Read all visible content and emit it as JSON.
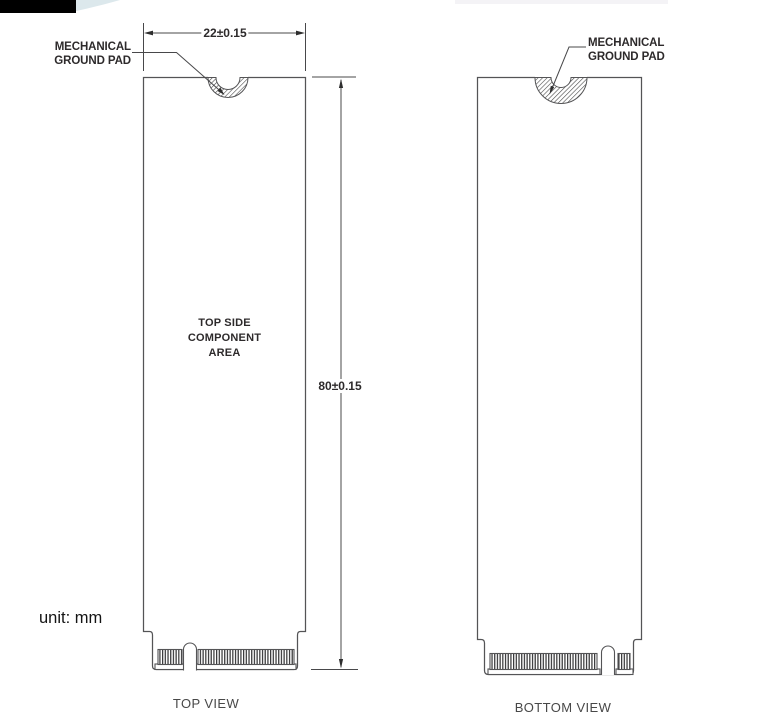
{
  "page": {
    "unit_note": "unit: mm"
  },
  "top_view": {
    "caption": "TOP VIEW",
    "ground_pad_label": {
      "line1": "MECHANICAL",
      "line2": "GROUND PAD"
    },
    "component_area": {
      "line1": "TOP SIDE",
      "line2": "COMPONENT",
      "line3": "AREA"
    },
    "dimensions": {
      "width": "22±0.15",
      "height": "80±0.15"
    }
  },
  "bottom_view": {
    "caption": "BOTTOM VIEW",
    "ground_pad_label": {
      "line1": "MECHANICAL",
      "line2": "GROUND PAD"
    }
  },
  "icons": {
    "ground_pad_notch": "hatched-semicircle-notch",
    "edge_connector": "gold-finger-edge-connector"
  },
  "colors": {
    "outline": "#545456",
    "dimension_line": "#48484a",
    "hatch": "#474747",
    "arrow": "#2e2e2e",
    "text": "#2d2a2b",
    "black_bar": "#000000",
    "swoosh": "#dce8ec"
  }
}
